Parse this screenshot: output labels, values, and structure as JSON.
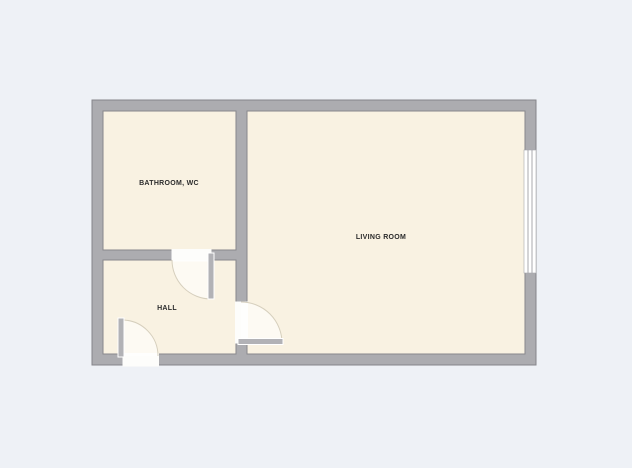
{
  "palette": {
    "background": "#eef1f6",
    "wall": "#acacb0",
    "wallOutline": "#85858a",
    "room": "#f9f2e2",
    "roomOutline": "#87878c",
    "opening": "#fdfdfb",
    "swing": "#ffffff",
    "arc": "#d6cfbd",
    "leaf": "#b2b2b6",
    "leafStroke": "#ffffff",
    "windowFill": "#ffffff",
    "windowLine": "#a8a8ad",
    "label": "#2b2b2b"
  },
  "rooms": {
    "bathroom": {
      "label": "BATHROOM, WC"
    },
    "hall": {
      "label": "HALL"
    },
    "living": {
      "label": "LIVING ROOM"
    }
  },
  "symbols": {
    "doors": [
      "bathroom-door",
      "living-room-door",
      "entrance-door"
    ],
    "window": "window"
  }
}
